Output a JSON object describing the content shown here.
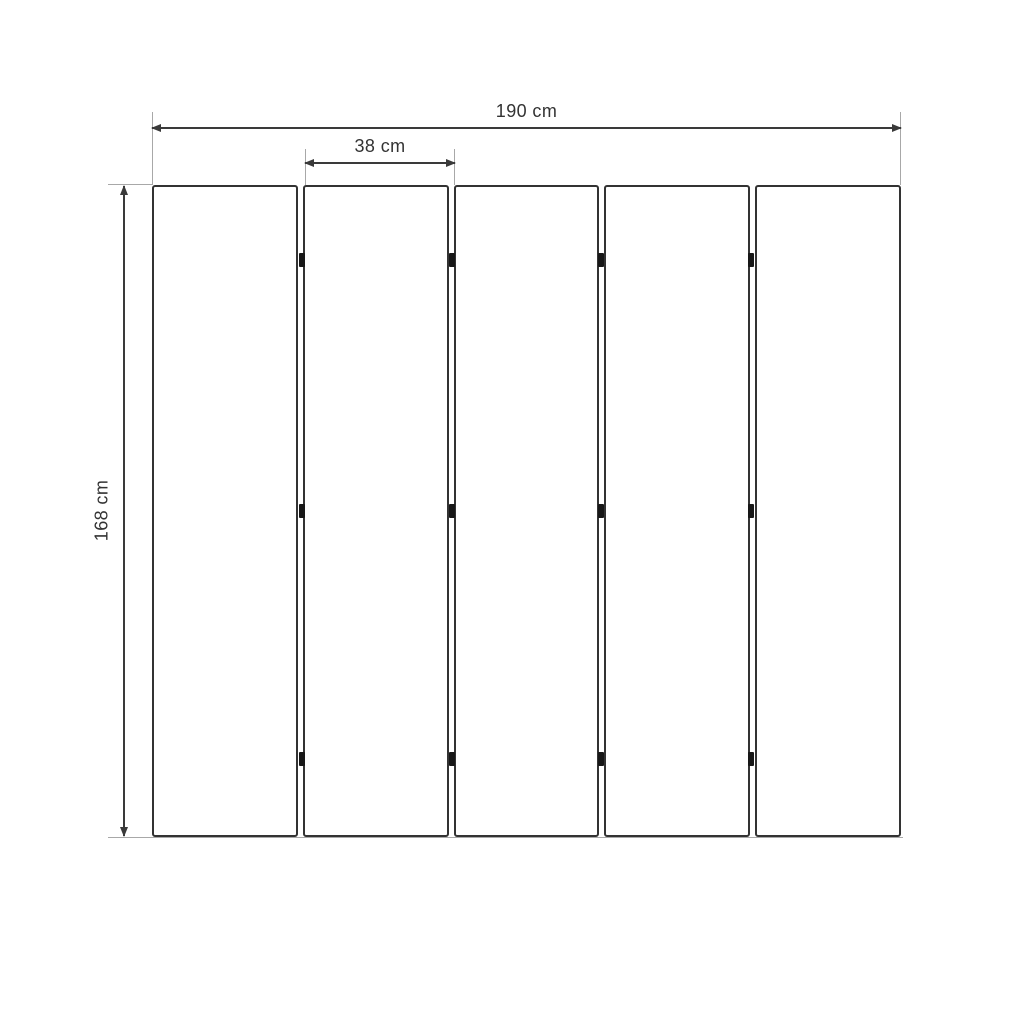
{
  "diagram": {
    "type": "dimension-drawing",
    "labels": {
      "total_width": "190 cm",
      "panel_width": "38 cm",
      "height": "168 cm"
    },
    "panel_count": 5,
    "hinge_columns": 4,
    "hinge_rows": 3,
    "colors": {
      "background": "#ffffff",
      "panel_outline": "#333333",
      "dimension_line": "#3a3a3a",
      "extension_line": "#a8a8a8",
      "hinge": "#171717",
      "text": "#333333"
    }
  }
}
